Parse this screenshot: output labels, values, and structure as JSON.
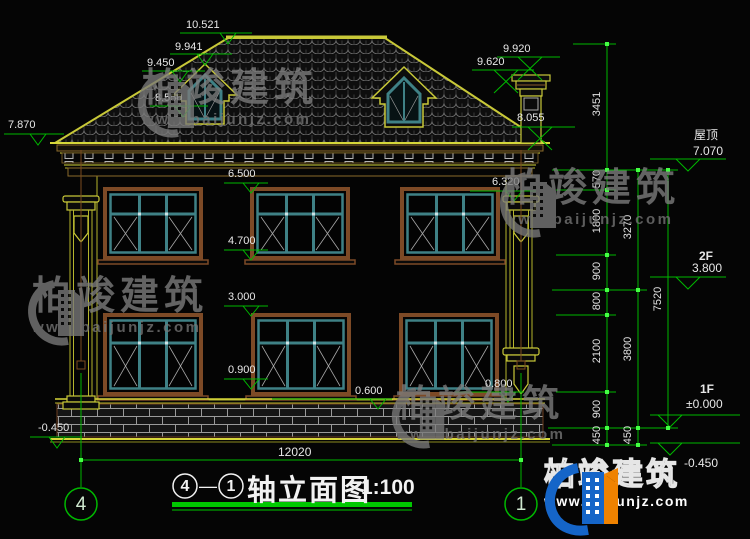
{
  "watermark": {
    "brand": "柏竣建筑",
    "url": "www.baijunjz.com"
  },
  "brand_logo": {
    "brand": "柏竣建筑",
    "url": "www.baijunjz.com"
  },
  "title_block": {
    "axis_from": "4",
    "separator": "—",
    "axis_to": "1",
    "title": "轴立面图",
    "scale": "1:100"
  },
  "axis_bubbles": {
    "left": "4",
    "right": "1"
  },
  "levels": {
    "roof_label": "屋顶",
    "roof_value": "7.070",
    "f2_label": "2F",
    "f2_value": "3.800",
    "f1_label": "1F",
    "f1_value": "±0.000",
    "ground_value": "-0.450"
  },
  "elevation_marks": {
    "ridge": "10.521",
    "dormer_ridge": "9.941",
    "dormer_eave": "9.450",
    "dormer_sill": "8.550",
    "eave_left": "7.870",
    "chimney_top": "9.920",
    "chimney_cap": "9.620",
    "eave_right": "8.055",
    "f2_window_head": "6.500",
    "f2_window_head_right": "6.320",
    "f2_window_sill": "4.700",
    "f1_window_head": "3.000",
    "f1_window_sill": "0.900",
    "plinth_top": "0.600",
    "pilaster_base_right": "0.800",
    "ground_left": "-0.450"
  },
  "dimensions": {
    "chain_inner": [
      "3451",
      "570",
      "1800",
      "900",
      "800",
      "2100",
      "900",
      "450"
    ],
    "chain_mid": [
      "3270",
      "3800",
      "450"
    ],
    "chain_outer": [
      "7520"
    ],
    "total_width": "12020"
  },
  "colors": {
    "dimension_green": "#00b800",
    "outline_yellow": "#b9b93a",
    "frame_brown": "#7d4a26",
    "window_teal": "#3f8186"
  }
}
